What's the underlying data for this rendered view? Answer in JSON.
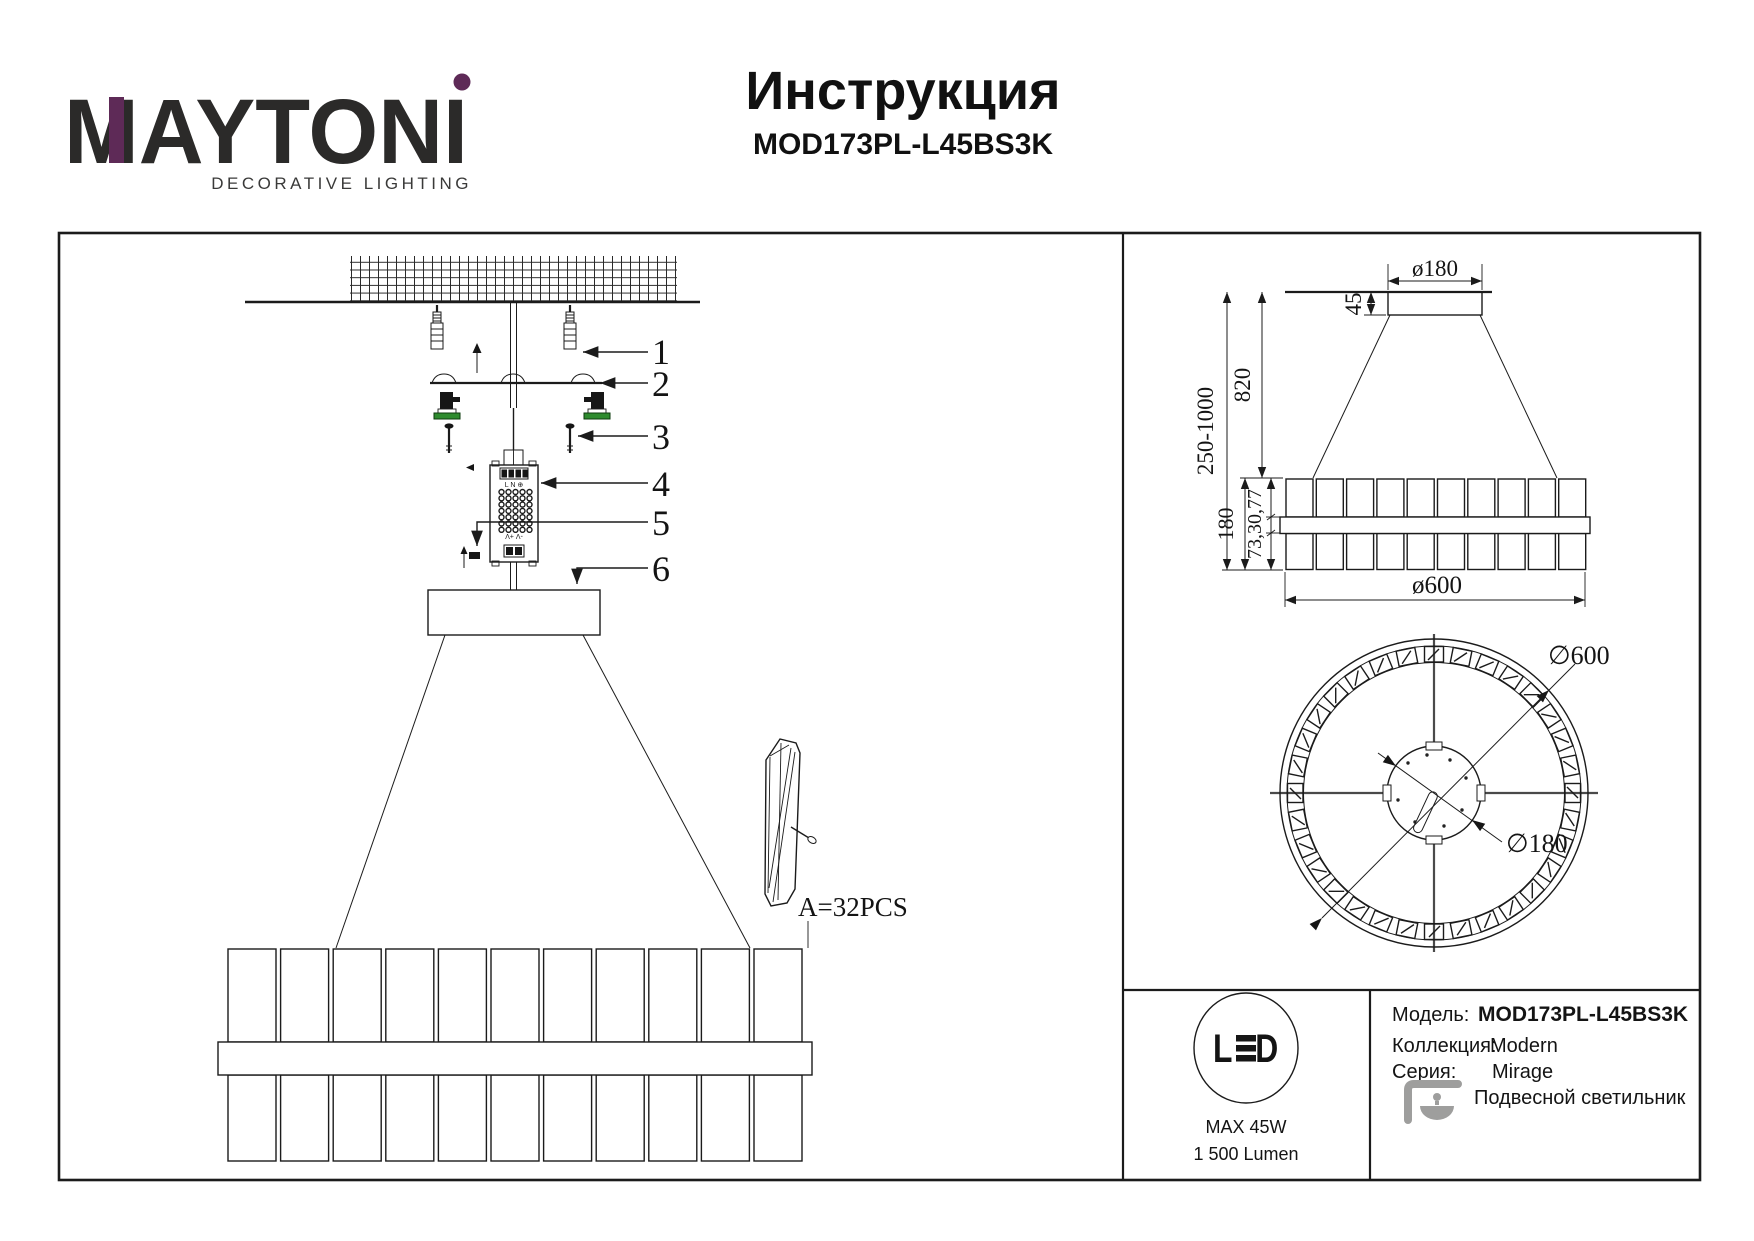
{
  "header": {
    "brand": "MAYTONI",
    "tagline": "DECORATIVE LIGHTING",
    "title": "Инструкция",
    "model": "MOD173PL-L45BS3K"
  },
  "assembly": {
    "callout_1": "1",
    "callout_2": "2",
    "callout_3": "3",
    "callout_4": "4",
    "callout_5": "5",
    "callout_6": "6",
    "detail_count_label": "A=32PCS",
    "driver_terminals_top": "L N ⊕",
    "driver_terminals_bottom": "-V +V"
  },
  "side_view_dims": {
    "canopy_diameter": "ø180",
    "canopy_height": "45",
    "suspension_range": "250-1000",
    "height_to_ring": "820",
    "ring_height": "180",
    "ring_sections": "73,30,77",
    "ring_diameter": "ø600"
  },
  "top_view_dims": {
    "outer_diameter": "∅600",
    "canopy_diameter": "∅180"
  },
  "spec": {
    "led_badge": "LED",
    "max_power": "MAX 45W",
    "luminous_flux": "1 500 Lumen",
    "rows": [
      {
        "label": "Модель:",
        "value": "MOD173PL-L45BS3K"
      },
      {
        "label": "Коллекция:",
        "value": "Modern"
      },
      {
        "label": "Серия:",
        "value": "Mirage"
      },
      {
        "label": "",
        "value": "Подвесной светильник"
      }
    ]
  },
  "colors": {
    "brand_purple": "#5e2a57",
    "icon_gray": "#9e9e9d",
    "terminal_green": "#2e8b2e"
  }
}
